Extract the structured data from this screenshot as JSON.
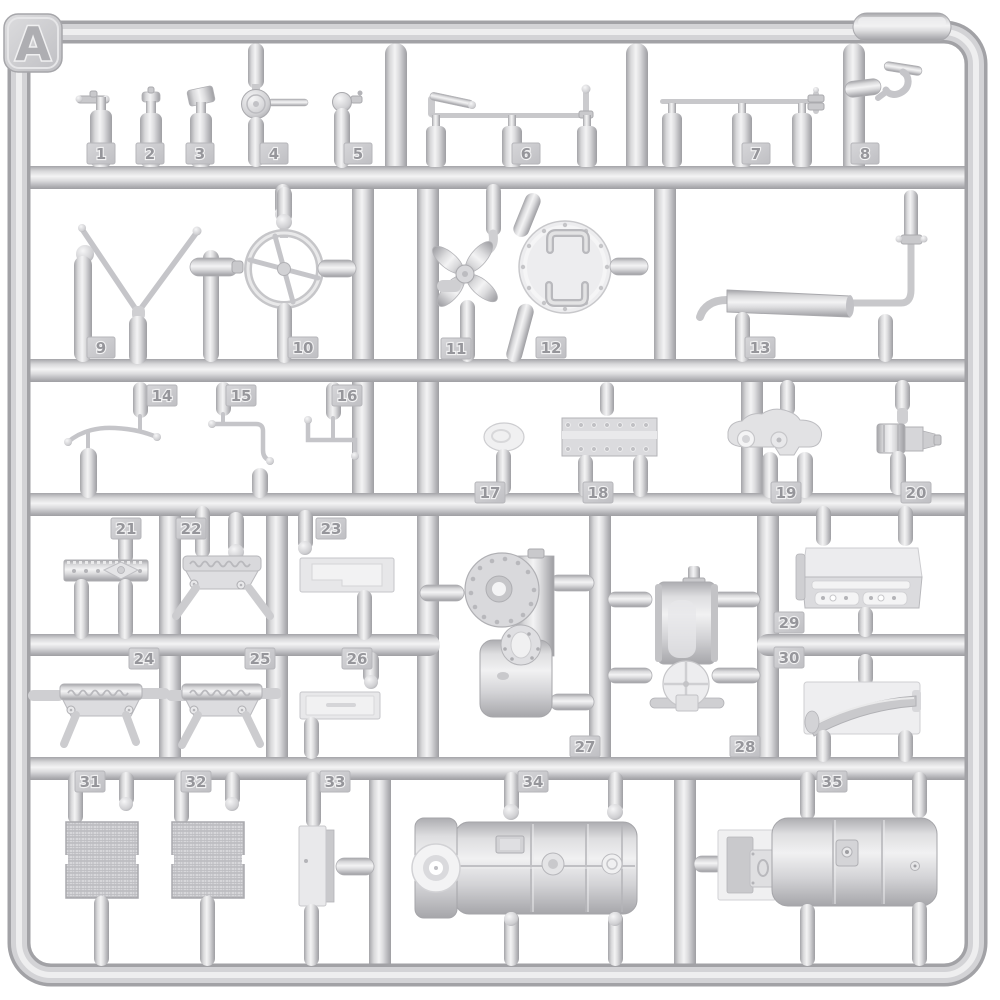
{
  "sprue": {
    "letter": "A",
    "part_count": 35,
    "colors": {
      "background": "#ffffff",
      "plastic_mid": "#d6d6d9",
      "plastic_highlight": "#f2f2f3",
      "plastic_shadow": "#a8a8ac",
      "tag_fill": "#c9c9cc",
      "number_fill": "#96969b"
    },
    "parts": [
      {
        "n": "1",
        "name": "valve-bottle"
      },
      {
        "n": "2",
        "name": "capped-bottle"
      },
      {
        "n": "3",
        "name": "nozzle-bottle"
      },
      {
        "n": "4",
        "name": "signal-disc-rod"
      },
      {
        "n": "5",
        "name": "ball-fitting"
      },
      {
        "n": "6",
        "name": "lever-linkage-bar"
      },
      {
        "n": "7",
        "name": "rod-linkage-bar"
      },
      {
        "n": "8",
        "name": "mounting-hook"
      },
      {
        "n": "9",
        "name": "v-brace"
      },
      {
        "n": "10",
        "name": "steering-wheel"
      },
      {
        "n": "11",
        "name": "engine-fan"
      },
      {
        "n": "12",
        "name": "round-hatch"
      },
      {
        "n": "13",
        "name": "exhaust-muffler"
      },
      {
        "n": "14",
        "name": "bent-wire"
      },
      {
        "n": "15",
        "name": "bent-pipe"
      },
      {
        "n": "16",
        "name": "angled-rod"
      },
      {
        "n": "17",
        "name": "oval-pad"
      },
      {
        "n": "18",
        "name": "riveted-valve-cover"
      },
      {
        "n": "19",
        "name": "bracket-casting"
      },
      {
        "n": "20",
        "name": "pump-body"
      },
      {
        "n": "21",
        "name": "riveted-strip"
      },
      {
        "n": "22",
        "name": "lettered-panel"
      },
      {
        "n": "23",
        "name": "stepped-panel"
      },
      {
        "n": "24",
        "name": "lettered-panel"
      },
      {
        "n": "25",
        "name": "lettered-panel"
      },
      {
        "n": "26",
        "name": "data-plate-panel"
      },
      {
        "n": "27",
        "name": "transmission-housing"
      },
      {
        "n": "28",
        "name": "winch-drum"
      },
      {
        "n": "29",
        "name": "tread-step"
      },
      {
        "n": "30",
        "name": "fender-step"
      },
      {
        "n": "31",
        "name": "radiator-mesh"
      },
      {
        "n": "32",
        "name": "radiator-mesh"
      },
      {
        "n": "33",
        "name": "narrow-panel"
      },
      {
        "n": "34",
        "name": "cylindrical-tank"
      },
      {
        "n": "35",
        "name": "tank-with-bracket"
      }
    ]
  }
}
